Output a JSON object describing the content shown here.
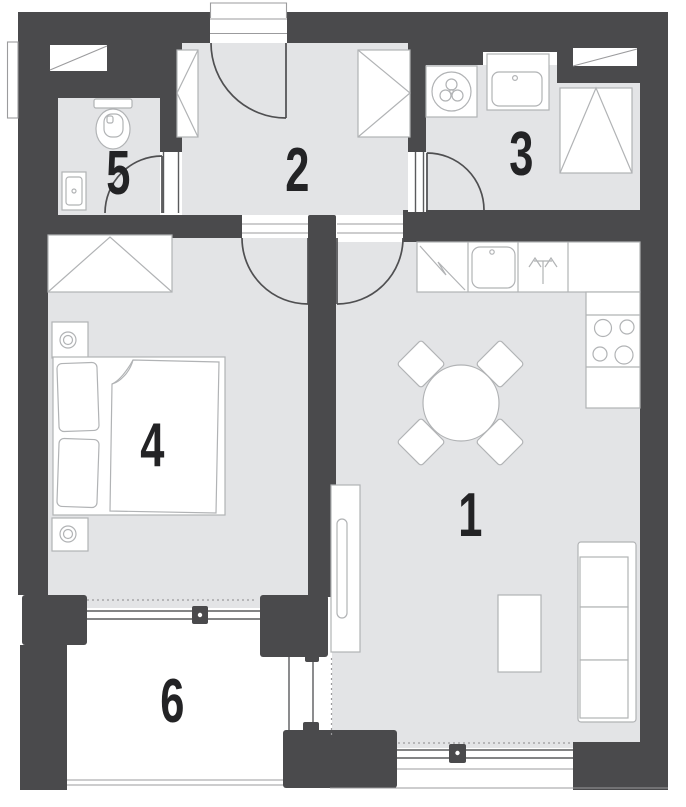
{
  "plan": {
    "title": "apartment floor plan",
    "rooms": [
      {
        "number": "1",
        "name": "living-room-kitchen"
      },
      {
        "number": "2",
        "name": "hallway"
      },
      {
        "number": "3",
        "name": "utility-room"
      },
      {
        "number": "4",
        "name": "bedroom"
      },
      {
        "number": "5",
        "name": "bathroom"
      },
      {
        "number": "6",
        "name": "balcony"
      }
    ],
    "colors": {
      "wall": "#4a4a4c",
      "floor": "#e3e4e6",
      "outline": "#b1b3b5",
      "door": "#4f4f51",
      "win": "#5a5b5d",
      "thin": "#9b9b9d",
      "dash": "#9a9a9c",
      "number": "#232325"
    }
  }
}
